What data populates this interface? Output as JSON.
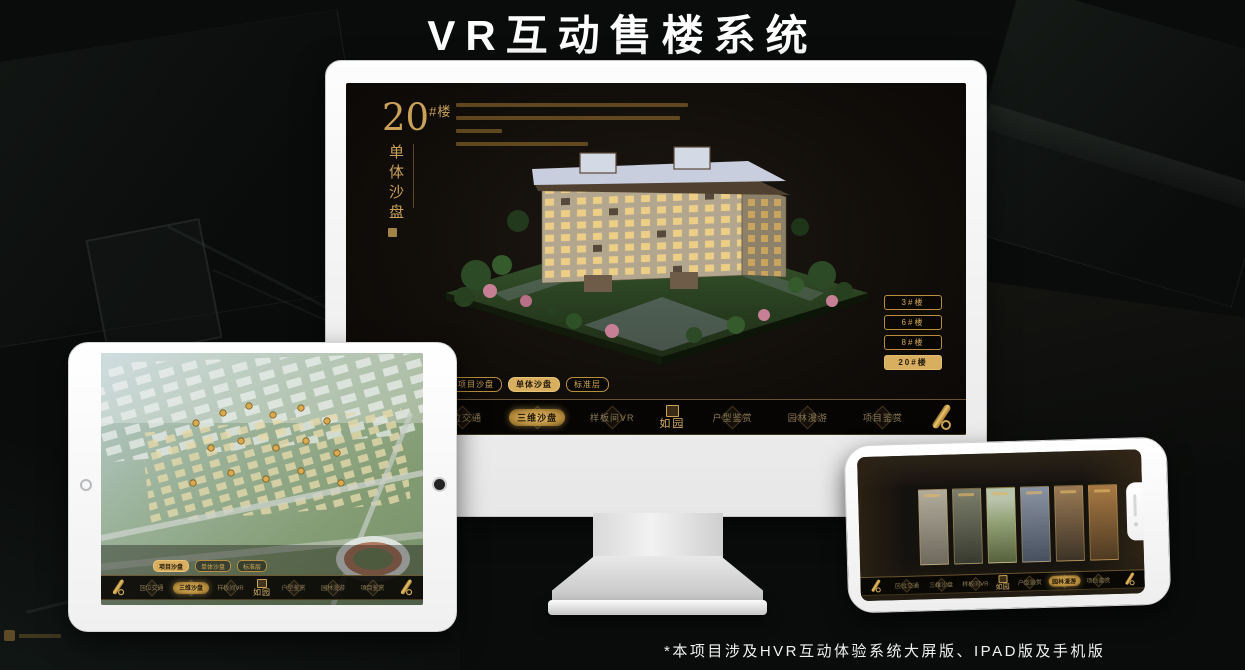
{
  "page": {
    "title": "VR互动售楼系统",
    "footnote": "*本项目涉及HVR互动体验系统大屏版、IPAD版及手机版"
  },
  "colors": {
    "gold": "#c9a158",
    "gold_selected": "#d8ae5f",
    "screen_bg": "#14100c"
  },
  "project_logo": "如园",
  "monitor": {
    "unit_number": "20",
    "unit_suffix": "#楼",
    "unit_title_vertical": "单体沙盘",
    "floor_buttons": [
      {
        "label": "3#楼",
        "selected": false
      },
      {
        "label": "6#楼",
        "selected": false
      },
      {
        "label": "8#楼",
        "selected": false
      },
      {
        "label": "20#楼",
        "selected": true
      }
    ],
    "sub_tabs": [
      {
        "label": "项目沙盘",
        "selected": false
      },
      {
        "label": "单体沙盘",
        "selected": true
      },
      {
        "label": "标准层",
        "selected": false
      }
    ],
    "nav_items": [
      {
        "label": "区位交通",
        "selected": false
      },
      {
        "label": "三维沙盘",
        "selected": true
      },
      {
        "label": "样板间VR",
        "selected": false
      },
      {
        "label": "户型鉴赏",
        "selected": false
      },
      {
        "label": "园林漫游",
        "selected": false
      },
      {
        "label": "项目鉴赏",
        "selected": false
      }
    ]
  },
  "tablet": {
    "sub_tabs": [
      {
        "label": "项目沙盘",
        "selected": true
      },
      {
        "label": "单体沙盘",
        "selected": false
      },
      {
        "label": "标准层",
        "selected": false
      }
    ],
    "nav_items": [
      {
        "label": "区位交通",
        "selected": false
      },
      {
        "label": "三维沙盘",
        "selected": true
      },
      {
        "label": "样板间VR",
        "selected": false
      },
      {
        "label": "户型鉴赏",
        "selected": false
      },
      {
        "label": "园林漫游",
        "selected": false
      },
      {
        "label": "项目鉴赏",
        "selected": false
      }
    ]
  },
  "phone": {
    "nav_items": [
      {
        "label": "区位交通",
        "selected": false
      },
      {
        "label": "三维沙盘",
        "selected": false
      },
      {
        "label": "样板间VR",
        "selected": false
      },
      {
        "label": "户型鉴赏",
        "selected": false
      },
      {
        "label": "园林漫游",
        "selected": true
      },
      {
        "label": "项目鉴赏",
        "selected": false
      }
    ]
  }
}
